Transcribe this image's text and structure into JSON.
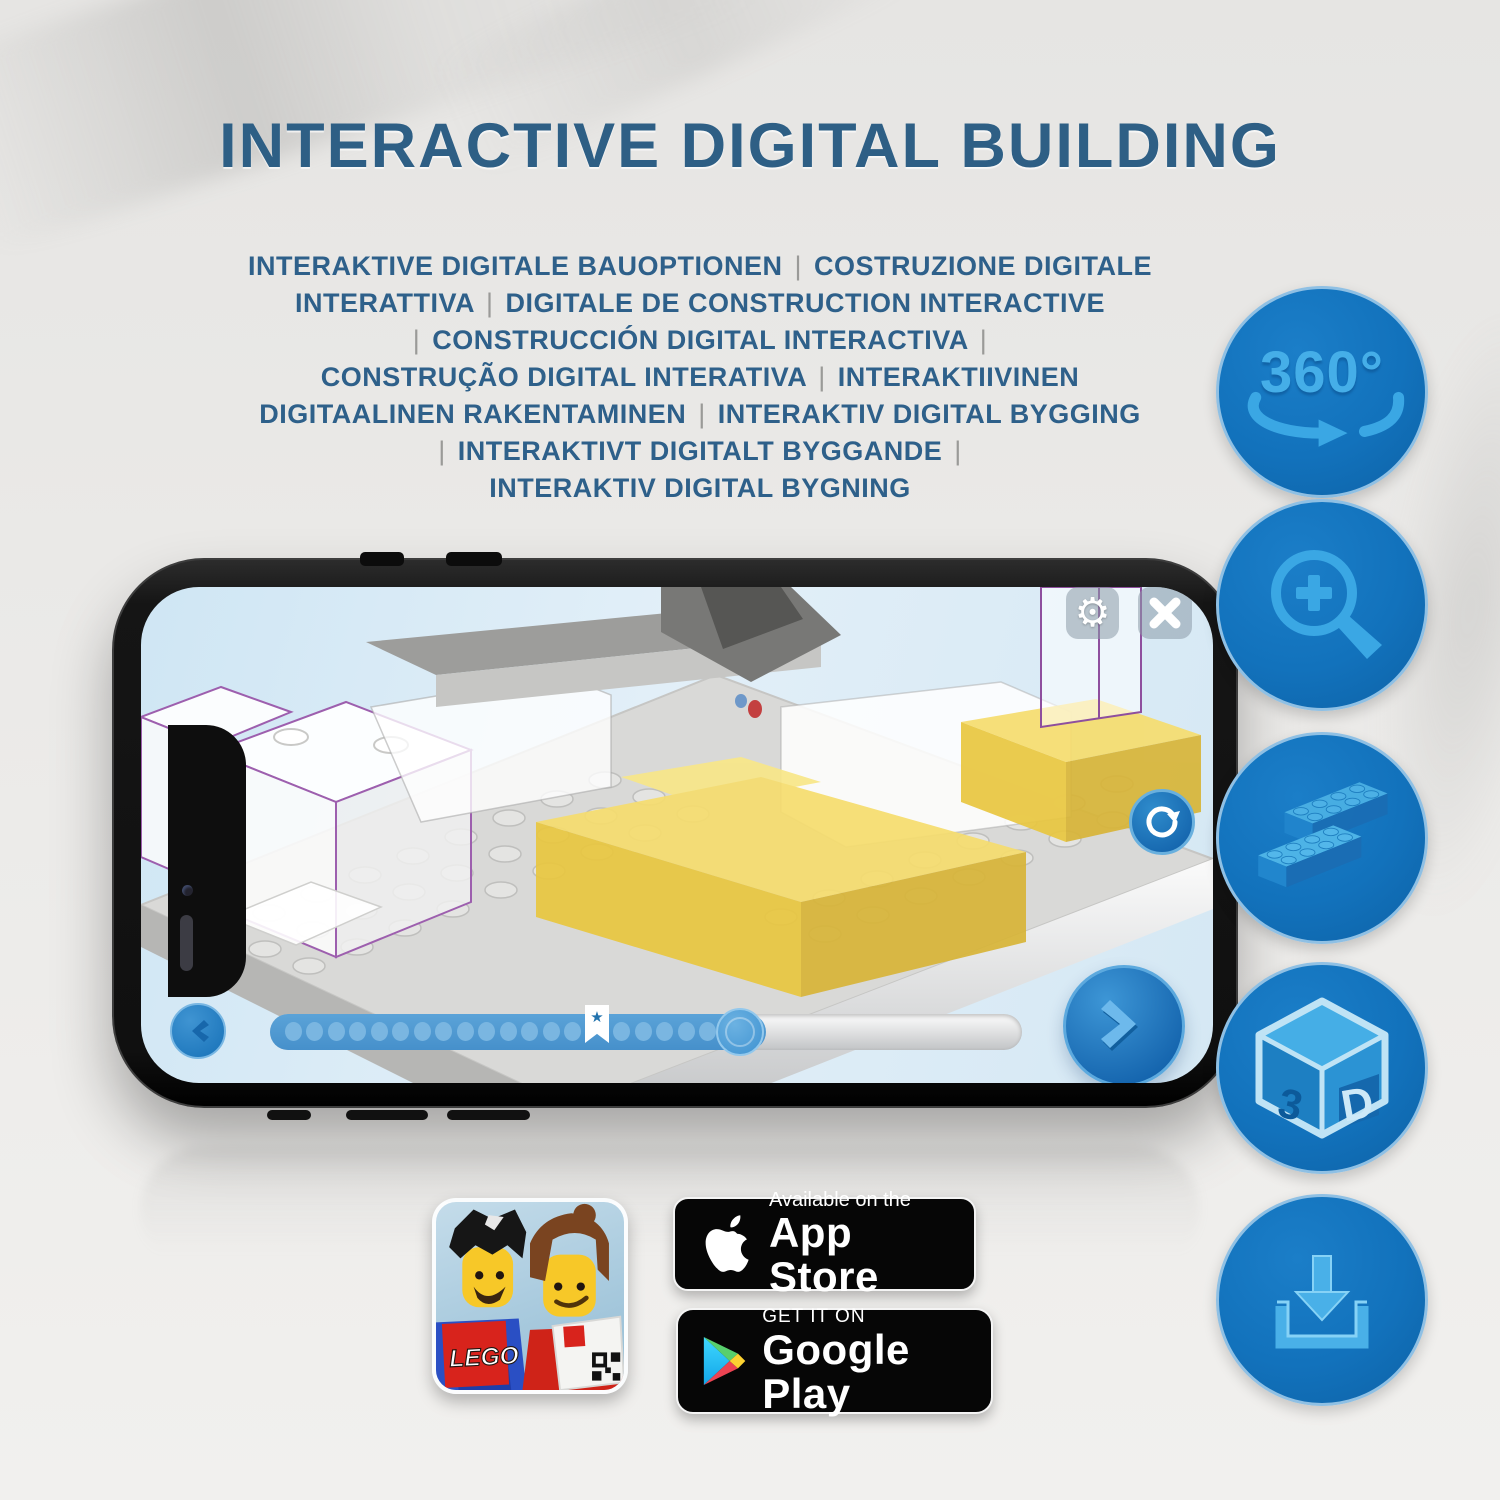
{
  "title": "INTERACTIVE DIGITAL BUILDING",
  "subtitle_lines": [
    "INTERAKTIVE DIGITALE BAUOPTIONEN | COSTRUZIONE DIGITALE",
    "INTERATTIVA | DIGITALE DE CONSTRUCTION INTERACTIVE",
    "| CONSTRUCCIÓN DIGITAL INTERACTIVA |",
    "CONSTRUÇÃO DIGITAL INTERATIVA | INTERAKTIIVINEN",
    "DIGITAALINEN RAKENTAMINEN | INTERAKTIV DIGITAL BYGGING",
    "| INTERAKTIVT DIGITALT BYGGANDE |",
    "INTERAKTIV DIGITAL BYGNING"
  ],
  "feature_icons": [
    {
      "name": "360-rotation-icon",
      "label": "360°"
    },
    {
      "name": "zoom-in-icon"
    },
    {
      "name": "lego-bricks-icon"
    },
    {
      "name": "3d-view-icon",
      "face_left": "3",
      "face_right": "D"
    },
    {
      "name": "download-icon"
    }
  ],
  "phone_app": {
    "buttons": {
      "gear_glyph": "⚙"
    },
    "progress": {
      "dots_before": 14,
      "dots_after": 5,
      "bookmark_star": "★"
    }
  },
  "app_icon": {
    "logo_text": "LEGO"
  },
  "store_badges": {
    "app_store": {
      "tagline": "Available on the",
      "store": "App Store"
    },
    "google_play": {
      "tagline": "GET IT ON",
      "store": "Google Play"
    }
  },
  "colors": {
    "heading_blue": "#2e5f85",
    "circle_blue": "#1272bc",
    "glyph_blue": "#3aa7e4",
    "brick_yellow": "#f3d95a"
  }
}
